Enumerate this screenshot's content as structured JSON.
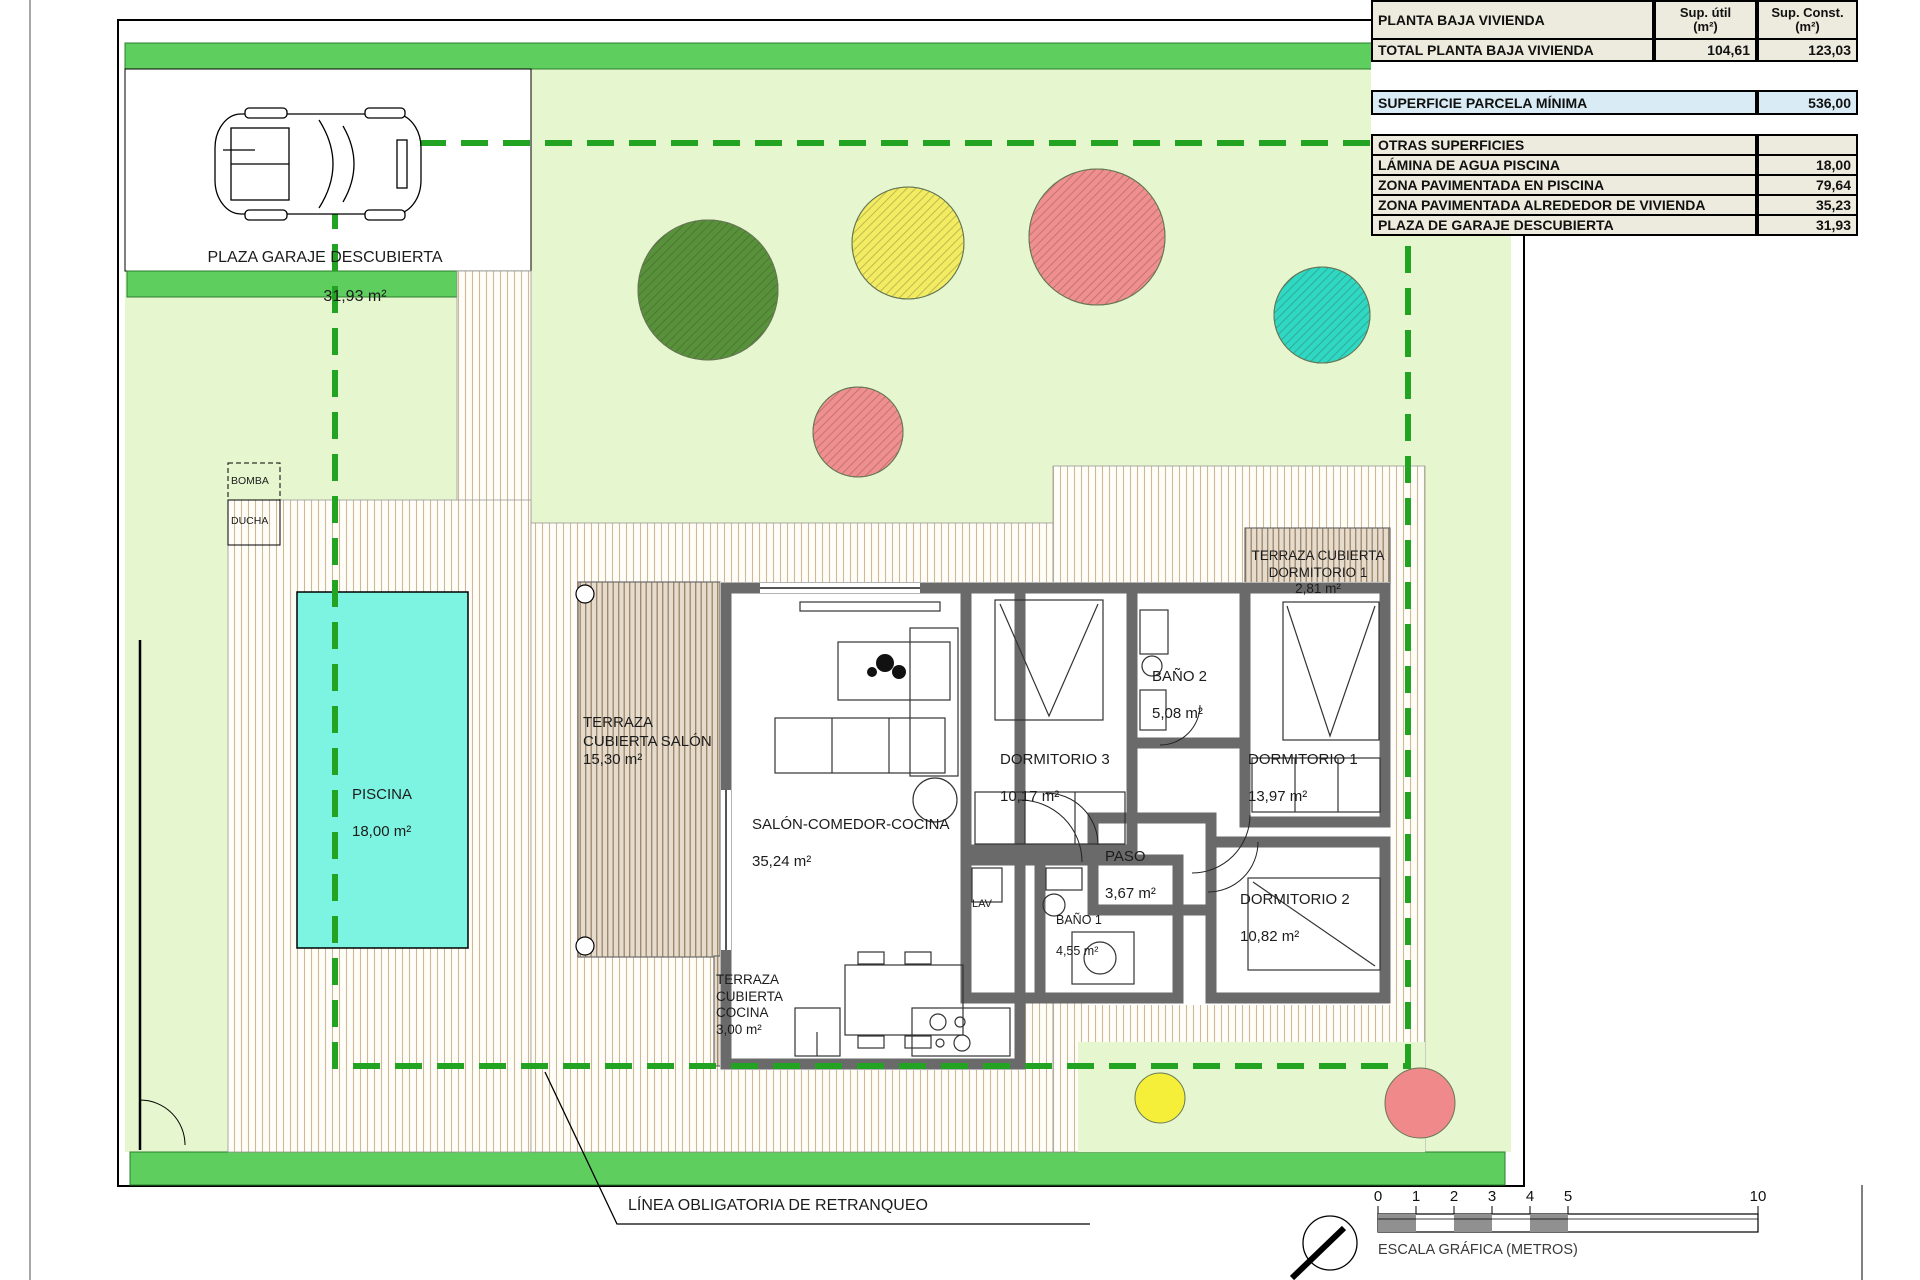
{
  "table": {
    "header": {
      "title": "PLANTA BAJA VIVIENDA",
      "col_util": "Sup. útil\n(m²)",
      "col_const": "Sup. Const.\n(m²)"
    },
    "total_row": {
      "label": "TOTAL PLANTA BAJA VIVIENDA",
      "util": "104,61",
      "const": "123,03"
    },
    "parcela_row": {
      "label": "SUPERFICIE PARCELA MÍNIMA",
      "value": "536,00"
    },
    "otras": {
      "title": "OTRAS SUPERFICIES",
      "rows": [
        {
          "label": "LÁMINA DE AGUA PISCINA",
          "value": "18,00"
        },
        {
          "label": "ZONA PAVIMENTADA EN PISCINA",
          "value": "79,64"
        },
        {
          "label": "ZONA PAVIMENTADA ALREDEDOR DE VIVIENDA",
          "value": "35,23"
        },
        {
          "label": "PLAZA DE GARAJE DESCUBIERTA",
          "value": "31,93"
        }
      ]
    }
  },
  "plan": {
    "garage": {
      "name": "PLAZA GARAJE DESCUBIERTA",
      "area": "31,93 m²"
    },
    "pool": {
      "name": "PISCINA",
      "area": "18,00 m²"
    },
    "equipment": {
      "bomba": "BOMBA",
      "ducha": "DUCHA"
    },
    "rooms": {
      "salon": {
        "name": "SALÓN-COMEDOR-COCINA",
        "area": "35,24 m²"
      },
      "dormitorio1": {
        "name": "DORMITORIO 1",
        "area": "13,97 m²"
      },
      "dormitorio2": {
        "name": "DORMITORIO 2",
        "area": "10,82 m²"
      },
      "dormitorio3": {
        "name": "DORMITORIO 3",
        "area": "10,17 m²"
      },
      "bano1": {
        "name": "BAÑO 1",
        "area": "4,55 m²"
      },
      "bano2": {
        "name": "BAÑO 2",
        "area": "5,08 m²"
      },
      "paso": {
        "name": "PASO",
        "area": "3,67 m²"
      },
      "lav": {
        "name": "LAV"
      },
      "terraza_salon": {
        "name": "TERRAZA CUBIERTA SALÓN",
        "area": "15,30 m²"
      },
      "terraza_cocina": {
        "name": "TERRAZA CUBIERTA COCINA",
        "area": "3,00 m²"
      },
      "terraza_dormitorio1": {
        "name": "TERRAZA CUBIERTA DORMITORIO 1",
        "area": "2,81 m²"
      }
    },
    "setback_label": "LÍNEA OBLIGATORIA DE RETRANQUEO"
  },
  "scale": {
    "caption": "ESCALA GRÁFICA (METROS)",
    "ticks": [
      "0",
      "1",
      "2",
      "3",
      "4",
      "5",
      "10"
    ]
  },
  "colors": {
    "hedge_green": "#5ecf5e",
    "garden_green": "#e6f6cf",
    "pool_cyan": "#7df4e2",
    "setback_dash_green": "#22a322",
    "wall_gray": "#6a6a6a",
    "table_cream": "#ecebdd",
    "table_blue": "#d9ecf5",
    "tree_green": "#57923b",
    "tree_yellow": "#f1ec62",
    "tree_salmon": "#ef8f8f",
    "tree_teal": "#2ed8c3",
    "scale_gray": "#909090"
  }
}
